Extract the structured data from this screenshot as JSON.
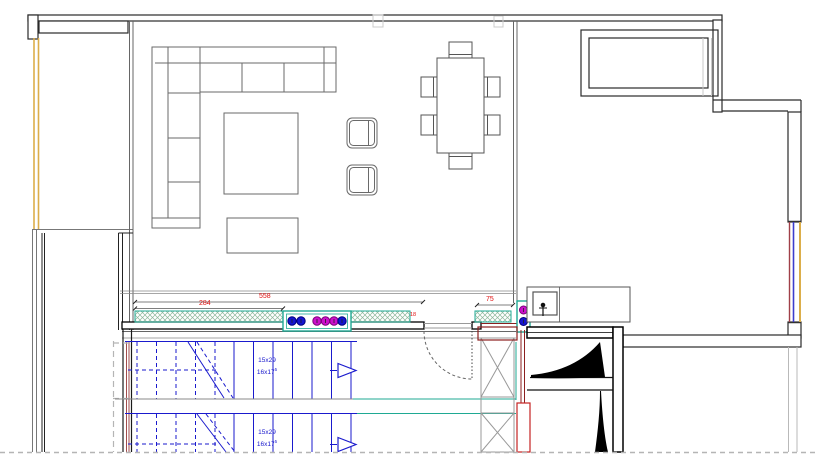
{
  "annotations": {
    "dim_284": "284",
    "dim_558": "558",
    "dim_18": "18",
    "dim_75": "75",
    "stair_spec_line1": "15x29",
    "stair_spec_line2": "16x17",
    "stair_spec_sup": "5"
  },
  "colors": {
    "wall_black": "#1c1c1c",
    "wall_gray": "#6e6e6e",
    "light_gray": "#b9b9b9",
    "stair_blue": "#1a1acd",
    "dimension_red": "#e01010",
    "hatch_green": "#8cb79b",
    "hatch_outline_teal": "#1fa993",
    "window_yellow": "#dcae4a",
    "window_blue": "#3c3ccc",
    "window_maroon": "#a04048",
    "structure_dark_red": "#8b1f1f",
    "socket_magenta": "#cc10cc",
    "socket_blue": "#1515d0"
  }
}
